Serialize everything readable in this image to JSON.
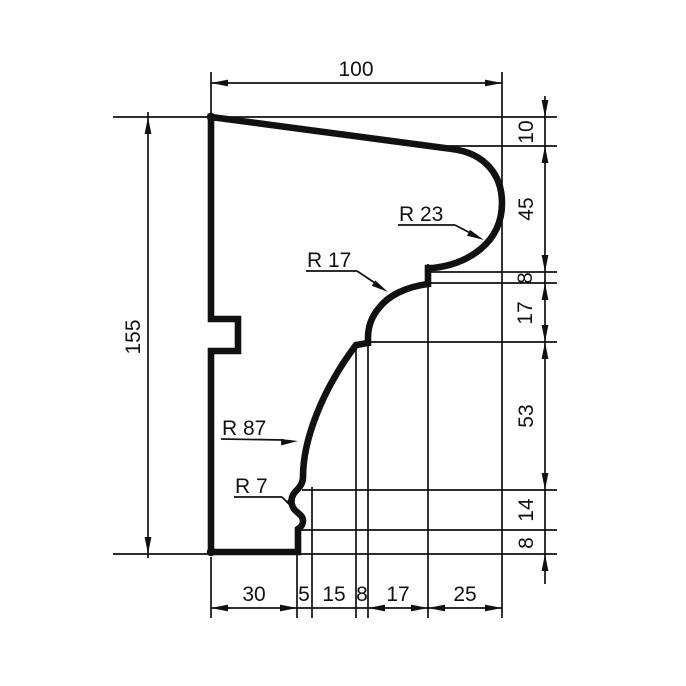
{
  "dimensions": {
    "top": "100",
    "left": "155",
    "right": [
      "10",
      "45",
      "8",
      "17",
      "53",
      "14",
      "8"
    ],
    "bottom": [
      "30",
      "5",
      "15",
      "8",
      "17",
      "25"
    ]
  },
  "radii": [
    "R 23",
    "R 17",
    "R 87",
    "R 7"
  ],
  "colors": {
    "ink": "#111111",
    "background": "#ffffff"
  }
}
